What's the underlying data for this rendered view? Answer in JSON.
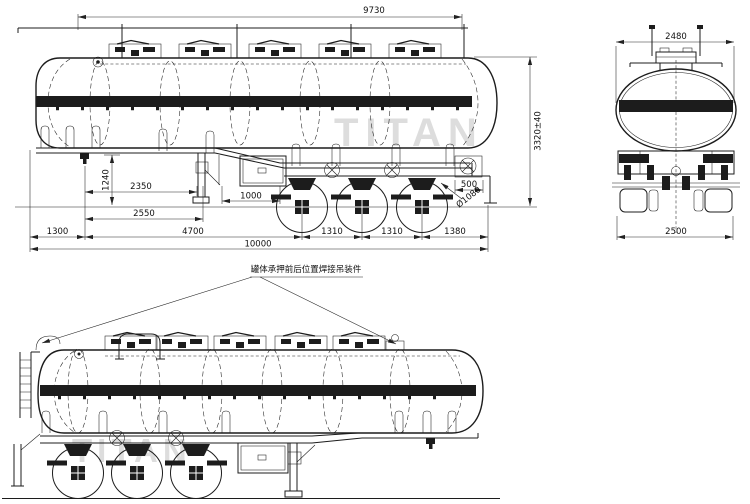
{
  "drawing": {
    "watermark": "TITAN",
    "side_view": {
      "dims": {
        "top_length": "9730",
        "overall_height": "3320±40",
        "frame_height": "1240",
        "kingpin_to_landing_leg": "2350",
        "kingpin_to_landing_foot": "2550",
        "toolbox_span": "1000",
        "rear_step": "500",
        "wheel_diameter": "Ø1080",
        "front_overhang": "1300",
        "kingpin_to_first_axle": "4700",
        "axle_spacing_1": "1310",
        "axle_spacing_2": "1310",
        "rear_overhang": "1380",
        "overall_length": "10000"
      }
    },
    "rear_view": {
      "dims": {
        "top_width": "2480",
        "overall_width": "2500"
      }
    },
    "bottom_view": {
      "callout": "罐体承押前后位置焊接吊装件"
    }
  }
}
